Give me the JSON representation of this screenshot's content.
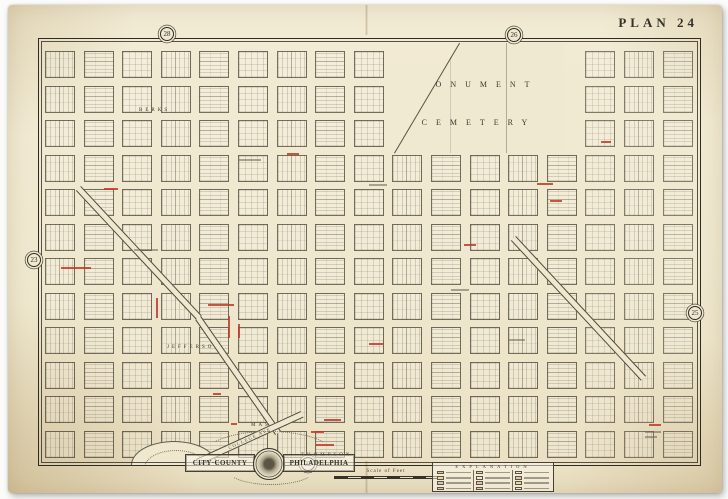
{
  "page": {
    "plate_label": "PLAN 24"
  },
  "adjacent_plates": {
    "top": "28",
    "top_right": "26",
    "left": "23",
    "right": "25",
    "bottom": "22"
  },
  "map": {
    "cemetery": {
      "line1": "MONUMENT",
      "line2": "CEMETERY"
    },
    "streets": [
      {
        "label": "BERKS"
      },
      {
        "label": "JEFFERSON"
      },
      {
        "label": "MASTER"
      },
      {
        "label": "THOMPSON"
      },
      {
        "label": "COLLEGE AVE"
      }
    ]
  },
  "cartouche": {
    "left": "CITY·COUNTY",
    "right": "PHILADELPHIA"
  },
  "legend": {
    "title": "EXPLANATION"
  },
  "scale": {
    "label": "Scale of Feet"
  },
  "colors": {
    "paper": "#efe8cf",
    "ink": "#39352b",
    "red_accent": "#c03a28"
  }
}
